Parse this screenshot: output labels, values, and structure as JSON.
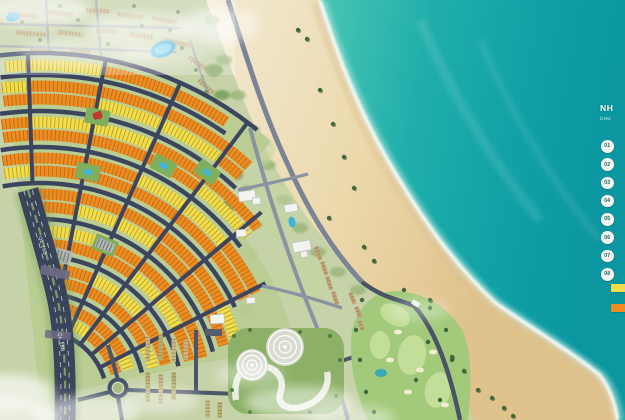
{
  "legend": {
    "title": "NH",
    "subtitle": "CHÚ",
    "items": [
      {
        "number": "01"
      },
      {
        "number": "02"
      },
      {
        "number": "03"
      },
      {
        "number": "04"
      },
      {
        "number": "05"
      },
      {
        "number": "06"
      },
      {
        "number": "07"
      },
      {
        "number": "08"
      }
    ],
    "swatches": [
      {
        "color": "#f2de49"
      },
      {
        "color": "#ef8b1f"
      }
    ]
  },
  "map": {
    "road_labels": [
      {
        "text": "QL 18B"
      },
      {
        "text": "QL 18B"
      }
    ]
  },
  "colors": {
    "ocean_deep": "#0b96a0",
    "ocean_near": "#49c6b4",
    "sand_light": "#f2ead4",
    "sand_wet": "#e0c28c",
    "road_dark": "#3b4560",
    "road_light": "#7b8494",
    "foam": "#ffffff"
  }
}
